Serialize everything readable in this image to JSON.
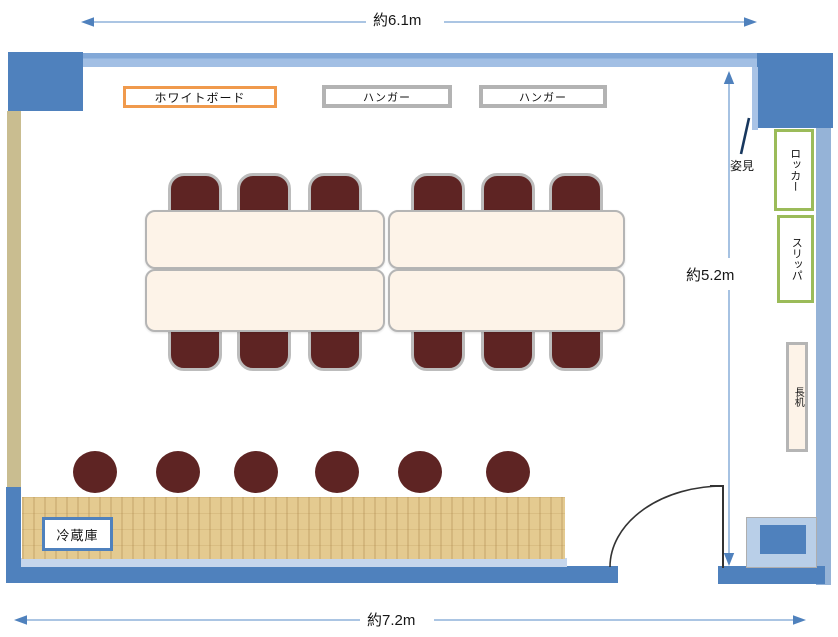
{
  "dimensions": {
    "top_width": "約6.1m",
    "right_height": "約5.2m",
    "bottom_width": "約7.2m"
  },
  "items": {
    "whiteboard": "ホワイトボード",
    "hanger_left": "ハンガー",
    "hanger_right": "ハンガー",
    "mirror": "姿見",
    "locker": "ロッカー",
    "slippers": "スリッパ",
    "long_desk": "長机",
    "refrigerator": "冷蔵庫"
  },
  "counts": {
    "meeting_tables": 4,
    "table_chairs": 12,
    "stools": 6
  },
  "colors": {
    "accent": "#4f81bd",
    "wall-light": "#95b3d7",
    "wall-tan": "#c9bd90",
    "wall-pale": "#c6d6ec",
    "chair": "#5e2423",
    "table-fill": "#fdf3e8",
    "green": "#9bbb59",
    "orange": "#f09a4d",
    "gray-border": "#b3b3b3",
    "wood": "#e4ca90",
    "arrow-line": "#8fb2da",
    "arrow-head": "#4f81bd",
    "mirror-line": "#17375e"
  }
}
